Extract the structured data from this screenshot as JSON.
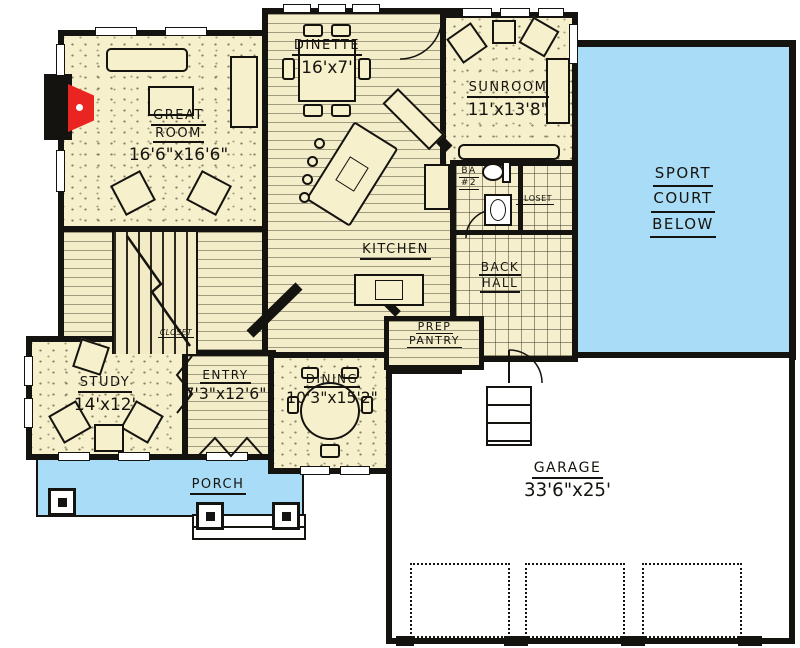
{
  "rooms": {
    "great_room": {
      "l1": "GREAT",
      "l2": "ROOM",
      "dims": "16'6\"x16'6\""
    },
    "dinette": {
      "name": "DINETTE",
      "dims": "16'x7'"
    },
    "sunroom": {
      "name": "SUNROOM",
      "dims": "11'x13'8\""
    },
    "sport_court": {
      "l1": "SPORT",
      "l2": "COURT",
      "l3": "BELOW"
    },
    "kitchen": {
      "name": "KITCHEN"
    },
    "back_hall": {
      "l1": "BACK",
      "l2": "HALL"
    },
    "bath2": {
      "l1": "BA",
      "l2": "#2"
    },
    "closet": {
      "name": "CLOSET"
    },
    "entry_closet": {
      "name": "CLOSET"
    },
    "prep_pantry": {
      "l1": "PREP",
      "l2": "PANTRY"
    },
    "entry": {
      "name": "ENTRY",
      "dims": "7'3\"x12'6\""
    },
    "dining": {
      "name": "DINING",
      "dims": "10'3\"x15'2\""
    },
    "study": {
      "name": "STUDY",
      "dims": "14'x12'"
    },
    "porch": {
      "name": "PORCH"
    },
    "garage": {
      "name": "GARAGE",
      "dims": "33'6\"x25'"
    }
  },
  "colors": {
    "floor_cream": "#f6f0cc",
    "outdoor_blue": "#a9dcf7",
    "wall_black": "#15130f",
    "fireplace_red": "#e92421"
  }
}
